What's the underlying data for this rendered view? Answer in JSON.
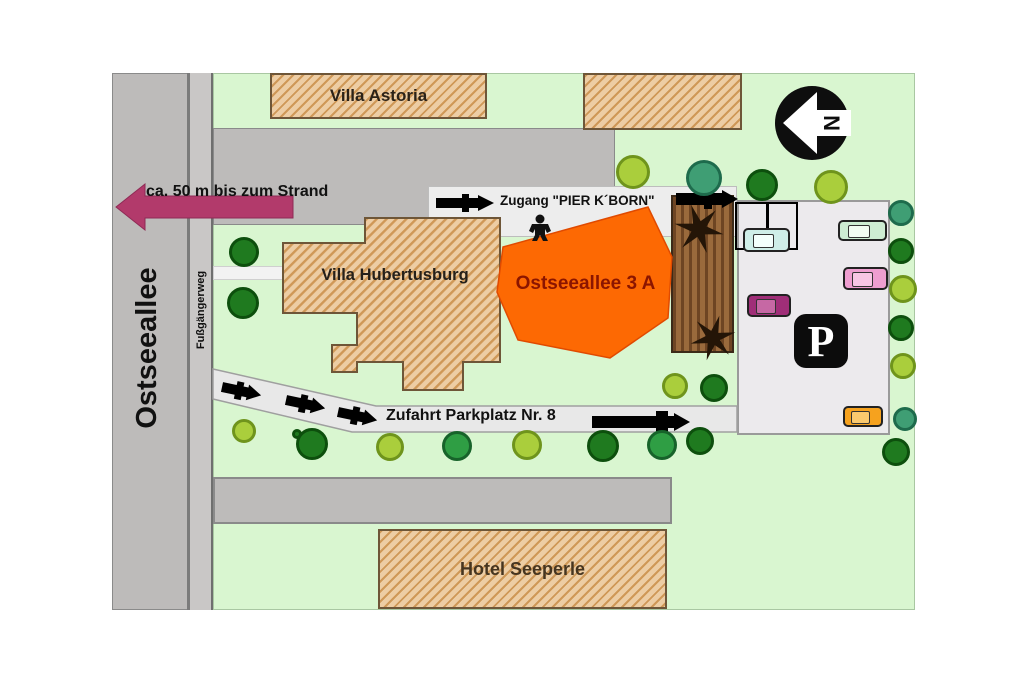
{
  "map": {
    "streets": {
      "ostseeallee": "Ostseeallee",
      "fussgaengerweg": "Fußgängerweg",
      "zufahrt": "Zufahrt Parkplatz Nr. 8"
    },
    "buildings": {
      "villa_astoria": "Villa Astoria",
      "villa_hubertusburg": "Villa Hubertusburg",
      "hotel_seeperle": "Hotel Seeperle"
    },
    "property": {
      "label": "Ostseeallee 3 A",
      "fill_color": "#fd6903",
      "label_color": "#8b1500"
    },
    "annotations": {
      "strand": "ca. 50 m bis zum Strand",
      "zugang": "Zugang \"PIER K´BORN\"",
      "north_letter": "N",
      "parking_symbol": "P"
    },
    "colors": {
      "ground_green": "#d9f6d0",
      "street_gray": "#bdbbba",
      "walkway_gray": "#ededed",
      "building_tan": "#edcda4",
      "deck_brown": "#9a6a3c",
      "strand_arrow": "#b23a6b",
      "property_orange": "#fd6903"
    },
    "trees": [
      {
        "x": 633,
        "y": 172,
        "r": 17,
        "c": "yellow"
      },
      {
        "x": 704,
        "y": 178,
        "r": 18,
        "c": "teal"
      },
      {
        "x": 762,
        "y": 185,
        "r": 16,
        "c": "dark"
      },
      {
        "x": 831,
        "y": 187,
        "r": 17,
        "c": "yellow"
      },
      {
        "x": 901,
        "y": 213,
        "r": 13,
        "c": "teal"
      },
      {
        "x": 901,
        "y": 251,
        "r": 13,
        "c": "dark"
      },
      {
        "x": 903,
        "y": 289,
        "r": 14,
        "c": "yellow"
      },
      {
        "x": 901,
        "y": 328,
        "r": 13,
        "c": "dark"
      },
      {
        "x": 903,
        "y": 366,
        "r": 13,
        "c": "yellow"
      },
      {
        "x": 905,
        "y": 419,
        "r": 12,
        "c": "teal"
      },
      {
        "x": 896,
        "y": 452,
        "r": 14,
        "c": "dark"
      },
      {
        "x": 244,
        "y": 252,
        "r": 15,
        "c": "dark"
      },
      {
        "x": 243,
        "y": 303,
        "r": 16,
        "c": "dark"
      },
      {
        "x": 675,
        "y": 386,
        "r": 13,
        "c": "yellow"
      },
      {
        "x": 714,
        "y": 388,
        "r": 14,
        "c": "dark"
      },
      {
        "x": 244,
        "y": 431,
        "r": 12,
        "c": "yellow"
      },
      {
        "x": 297,
        "y": 434,
        "r": 5,
        "c": "dark"
      },
      {
        "x": 312,
        "y": 444,
        "r": 16,
        "c": "dark"
      },
      {
        "x": 390,
        "y": 447,
        "r": 14,
        "c": "yellow"
      },
      {
        "x": 457,
        "y": 446,
        "r": 15,
        "c": "green"
      },
      {
        "x": 527,
        "y": 445,
        "r": 15,
        "c": "yellow"
      },
      {
        "x": 603,
        "y": 446,
        "r": 16,
        "c": "dark"
      },
      {
        "x": 662,
        "y": 445,
        "r": 15,
        "c": "green"
      },
      {
        "x": 700,
        "y": 441,
        "r": 14,
        "c": "dark"
      }
    ],
    "cars": [
      {
        "x": 743,
        "y": 228,
        "w": 47,
        "h": 24,
        "body": "#cfeee8",
        "win": "#f4fffc"
      },
      {
        "x": 838,
        "y": 220,
        "w": 49,
        "h": 21,
        "body": "#cdecd2",
        "win": "#f2fcf2"
      },
      {
        "x": 843,
        "y": 267,
        "w": 45,
        "h": 23,
        "body": "#ee9ed0",
        "win": "#f7c6e4"
      },
      {
        "x": 747,
        "y": 294,
        "w": 44,
        "h": 23,
        "body": "#a02e78",
        "win": "#c668a4"
      },
      {
        "x": 843,
        "y": 406,
        "w": 40,
        "h": 21,
        "body": "#f6a21e",
        "win": "#fac96e"
      }
    ]
  }
}
